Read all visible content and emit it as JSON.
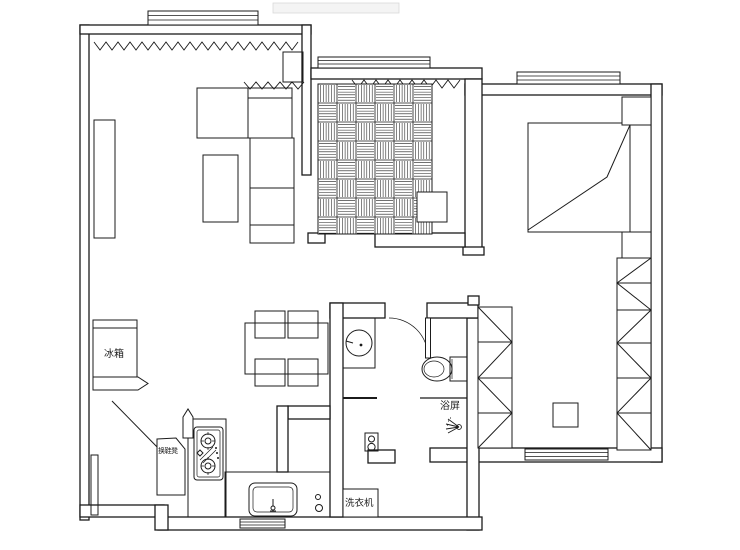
{
  "floor_plan": {
    "labels": {
      "fridge": "冰箱",
      "shoe_bench": "换鞋凳",
      "shower_screen": "浴屏",
      "washing_machine": "洗衣机"
    },
    "colors": {
      "line": "#1b1b1b",
      "background": "#ffffff"
    },
    "fixture_icons": [
      "refrigerator",
      "shoe-bench",
      "gas-stove",
      "kitchen-sink",
      "dining-table",
      "dining-chairs",
      "washbasin",
      "toilet",
      "shower-head",
      "shower-screen",
      "washing-machine",
      "double-bed",
      "nightstand",
      "wardrobe",
      "sofa",
      "coffee-table",
      "tv-cabinet",
      "tatami-mat",
      "window",
      "curtain",
      "door-swing"
    ]
  }
}
